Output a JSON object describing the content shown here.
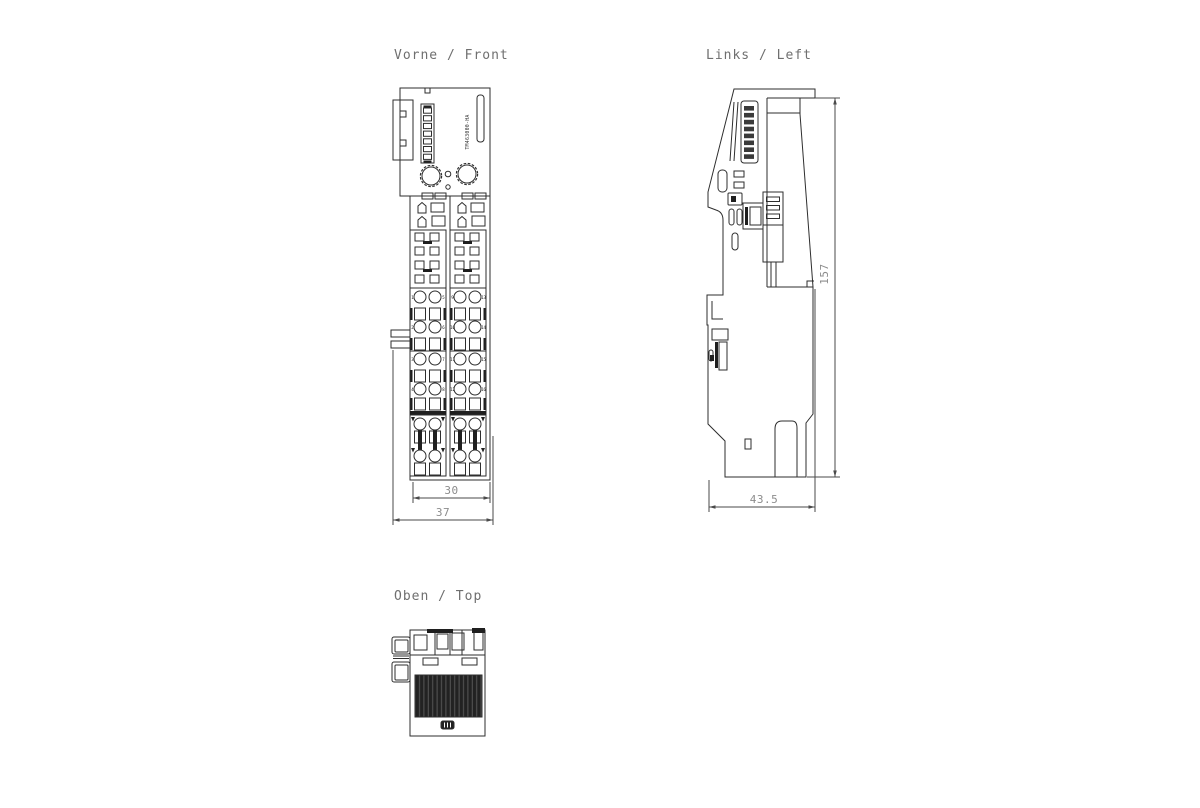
{
  "palette": {
    "background": "#ffffff",
    "line": "#2e2e2e",
    "dim_line": "#4a4a4a",
    "dim_text": "#8c8c8c",
    "label_text": "#6f6f6f",
    "dark_fill": "#1f1f1f"
  },
  "views": {
    "front": {
      "label": "Vorne / Front",
      "part_number": "TM463000-HA",
      "dimensions": {
        "terminal_width": "30",
        "overall_width": "37"
      },
      "terminal_numbers": {
        "row1": [
          "1",
          "5",
          "9",
          "13"
        ],
        "row2": [
          "2",
          "6",
          "10",
          "14"
        ],
        "row3": [
          "3",
          "7",
          "11",
          "15"
        ],
        "row4": [
          "4",
          "8",
          "12",
          "16"
        ]
      }
    },
    "left": {
      "label": "Links / Left",
      "dimensions": {
        "overall_height": "157",
        "overall_depth": "43.5"
      }
    },
    "top": {
      "label": "Oben / Top"
    }
  }
}
